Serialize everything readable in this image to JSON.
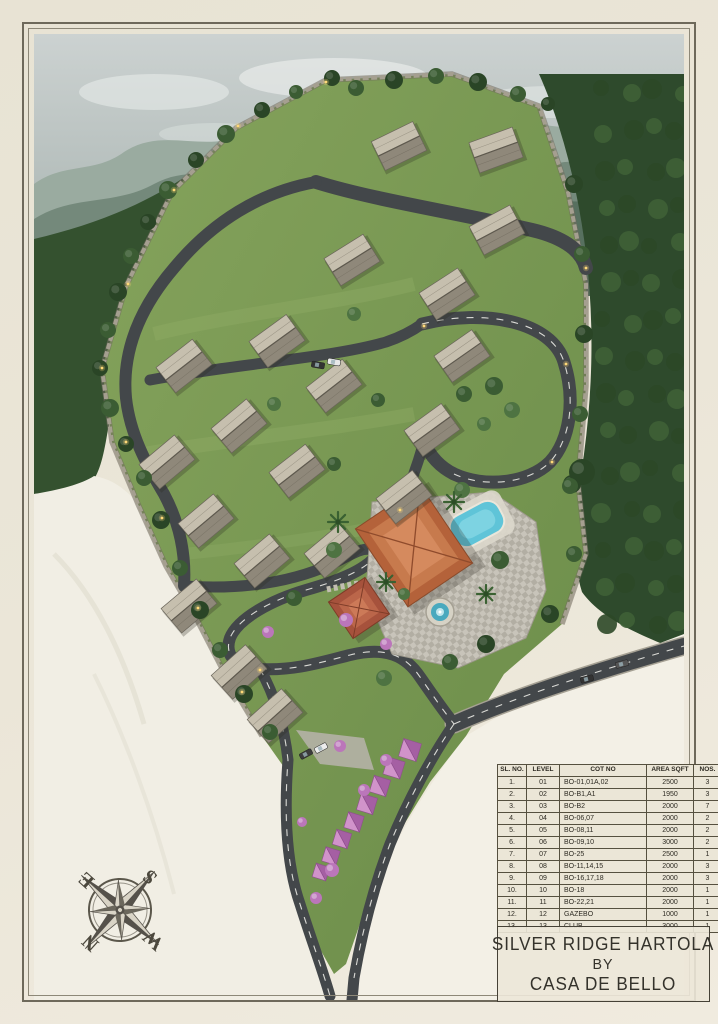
{
  "table": {
    "headers": [
      "SL. NO.",
      "LEVEL",
      "COT NO",
      "AREA SQFT",
      "NOS."
    ],
    "rows": [
      [
        "1.",
        "01",
        "BO-01,01A,02",
        "2500",
        "3"
      ],
      [
        "2.",
        "02",
        "BO-B1,A1",
        "1950",
        "3"
      ],
      [
        "3.",
        "03",
        "BO-B2",
        "2000",
        "7"
      ],
      [
        "4.",
        "04",
        "BO-06,07",
        "2000",
        "2"
      ],
      [
        "5.",
        "05",
        "BO-08,11",
        "2000",
        "2"
      ],
      [
        "6.",
        "06",
        "BO-09,10",
        "3000",
        "2"
      ],
      [
        "7.",
        "07",
        "BO-25",
        "2500",
        "1"
      ],
      [
        "8.",
        "08",
        "BO-11,14,15",
        "2000",
        "3"
      ],
      [
        "9.",
        "09",
        "BO-16,17,18",
        "2000",
        "3"
      ],
      [
        "10.",
        "10",
        "BO-18",
        "2000",
        "1"
      ],
      [
        "11.",
        "11",
        "BO-22,21",
        "2000",
        "1"
      ],
      [
        "12.",
        "12",
        "GAZEBO",
        "1000",
        "1"
      ],
      [
        "13.",
        "13",
        "CLUB",
        "3000",
        "1"
      ]
    ]
  },
  "title_block": {
    "line1": "SILVER RIDGE HARTOLA",
    "line2": "BY",
    "line3": "CASA DE BELLO"
  },
  "compass": {
    "north": "N",
    "south": "S",
    "east": "E",
    "west": "W"
  },
  "colors": {
    "paper": "#ebe6d8",
    "roof_slate": "#a39c8d",
    "club_roof": "#c2754a",
    "canopy_pink": "#bf7cbb",
    "pool_blue": "#63c5d8",
    "road_asphalt": "#43474a",
    "lawn_green": "#7a9a54"
  }
}
